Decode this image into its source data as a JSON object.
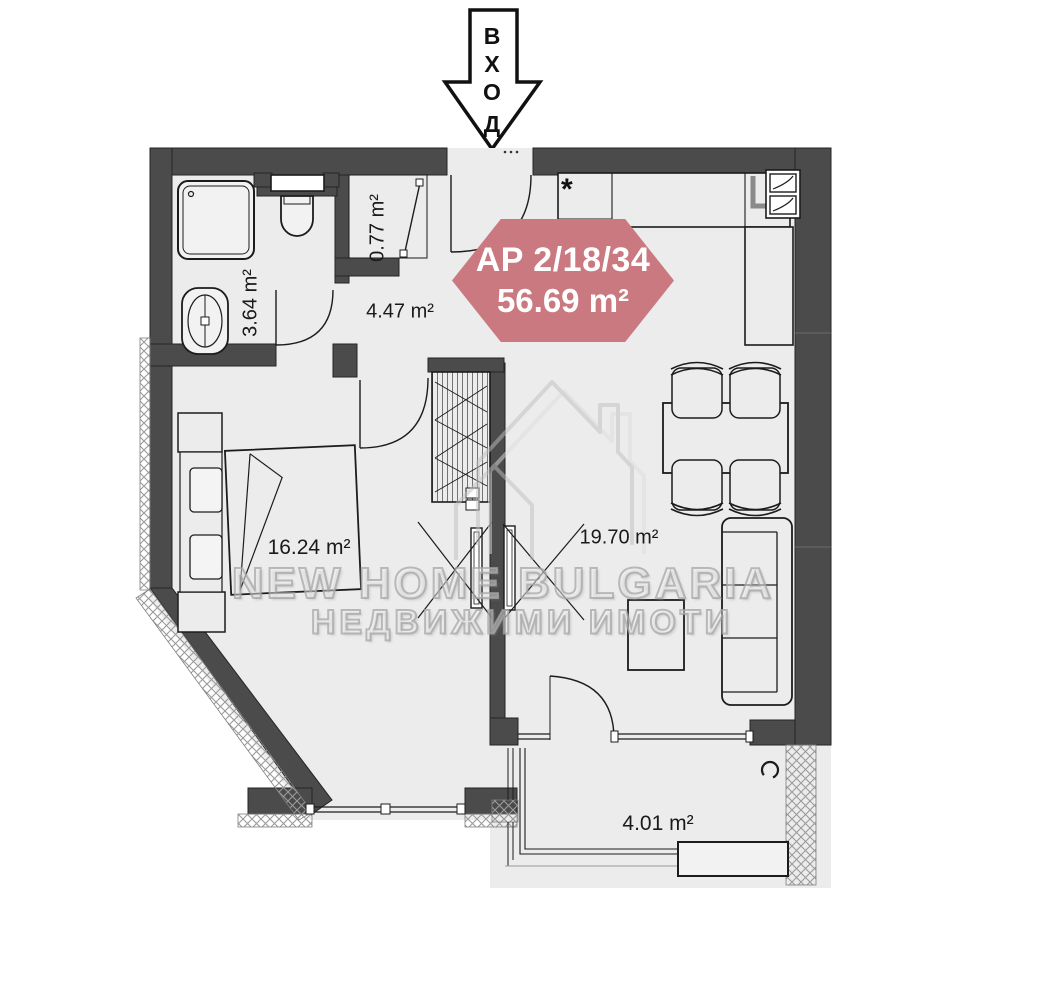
{
  "entrance": {
    "label": "ВХОД",
    "letters": [
      "В",
      "Х",
      "О",
      "Д"
    ]
  },
  "badge": {
    "unit": "AP 2/18/34",
    "area": "56.69 m²"
  },
  "rooms": {
    "bathroom": {
      "area": "3.64 m²"
    },
    "storage": {
      "area": "0.77 m²"
    },
    "hallway": {
      "area": "4.47 m²"
    },
    "bedroom": {
      "area": "16.24 m²"
    },
    "living_room": {
      "area": "19.70 m²"
    },
    "balcony": {
      "area": "4.01 m²"
    }
  },
  "watermark": {
    "line1": "NEW HOME BULGARIA",
    "line2": "НЕДВИЖИМИ ИМОТИ"
  },
  "symbols": {
    "kitchen_marker": "*"
  },
  "colors": {
    "wall": "#4b4b4b",
    "floor": "#ececec",
    "badge": "#c9797f",
    "line": "#1c1c1c",
    "watermark": "#bdbdbd"
  }
}
